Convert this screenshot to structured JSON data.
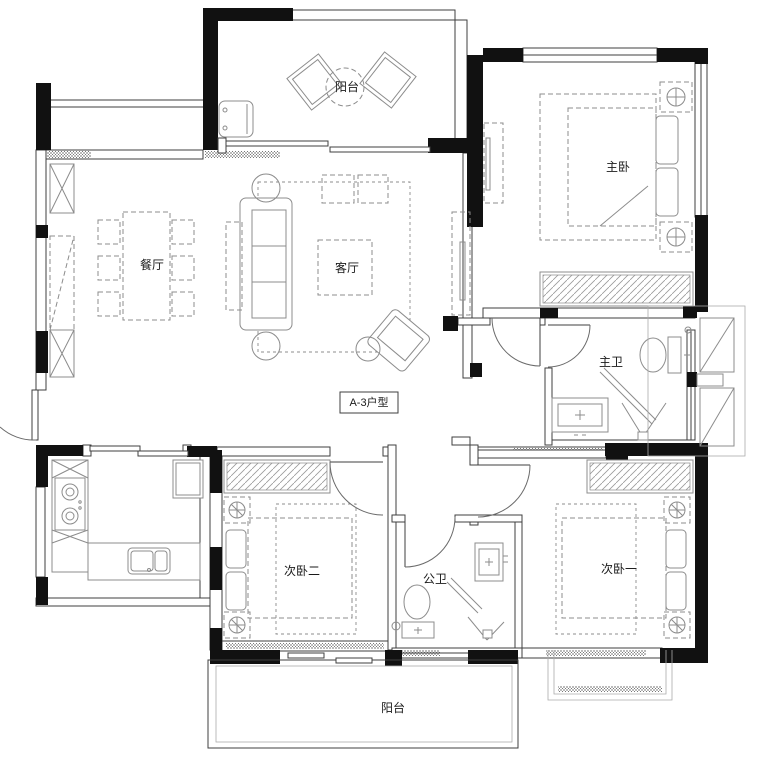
{
  "title": "A-3户型",
  "colors": {
    "wall": "#111111",
    "line": "#3f3f3f",
    "furniture": "#8c8c8c",
    "light": "#ababab",
    "text": "#1a1a1a",
    "bg": "#ffffff"
  },
  "rooms": {
    "balcony_top": {
      "label": "阳台"
    },
    "master_bedroom": {
      "label": "主卧"
    },
    "dining": {
      "label": "餐厅"
    },
    "living": {
      "label": "客厅"
    },
    "master_bath": {
      "label": "主卫"
    },
    "bedroom_two": {
      "label": "次卧二"
    },
    "public_bath": {
      "label": "公卫"
    },
    "bedroom_one": {
      "label": "次卧一"
    },
    "balcony_bottom": {
      "label": "阳台"
    }
  }
}
